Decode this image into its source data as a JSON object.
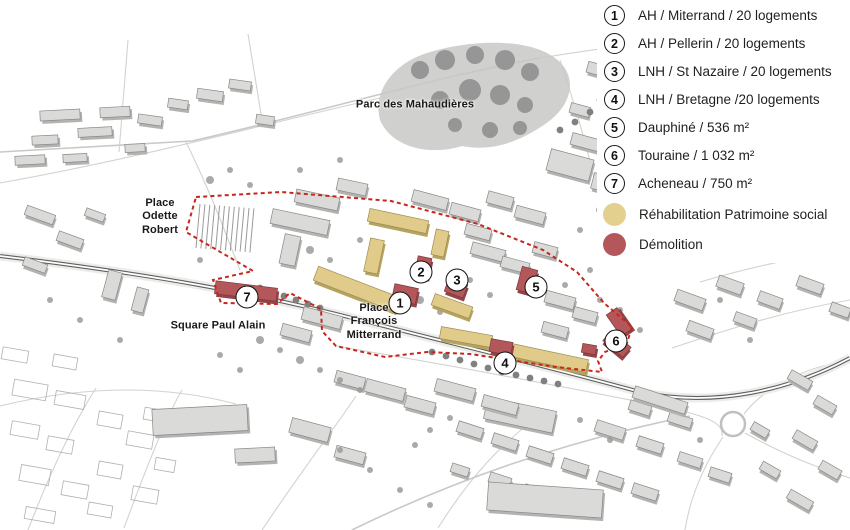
{
  "legend": {
    "items": [
      {
        "number": "1",
        "label": "AH / Miterrand / 20 logements"
      },
      {
        "number": "2",
        "label": "AH / Pellerin / 20 logements"
      },
      {
        "number": "3",
        "label": "LNH / St Nazaire / 20 logements"
      },
      {
        "number": "4",
        "label": "LNH / Bretagne /20 logements"
      },
      {
        "number": "5",
        "label": "Dauphiné / 536 m²"
      },
      {
        "number": "6",
        "label": "Touraine / 1 032 m²"
      },
      {
        "number": "7",
        "label": "Acheneau / 750 m²"
      }
    ],
    "swatches": [
      {
        "label": "Réhabilitation Patrimoine social",
        "color": "#e3cf8e"
      },
      {
        "label": "Démolition",
        "color": "#b4575a"
      }
    ]
  },
  "map": {
    "labels": [
      {
        "text": "Parc des Mahaudières"
      },
      {
        "text": "Place\nOdette\nRobert"
      },
      {
        "text": "Square Paul Alain"
      },
      {
        "text": "Place\nFrançois\nMitterrand"
      }
    ],
    "markers": [
      {
        "number": "1"
      },
      {
        "number": "2"
      },
      {
        "number": "3"
      },
      {
        "number": "4"
      },
      {
        "number": "5"
      },
      {
        "number": "6"
      },
      {
        "number": "7"
      }
    ]
  },
  "colors": {
    "rehabilitation": "#e0cb8a",
    "demolition": "#b4575a",
    "boundary": "#c8251d"
  }
}
